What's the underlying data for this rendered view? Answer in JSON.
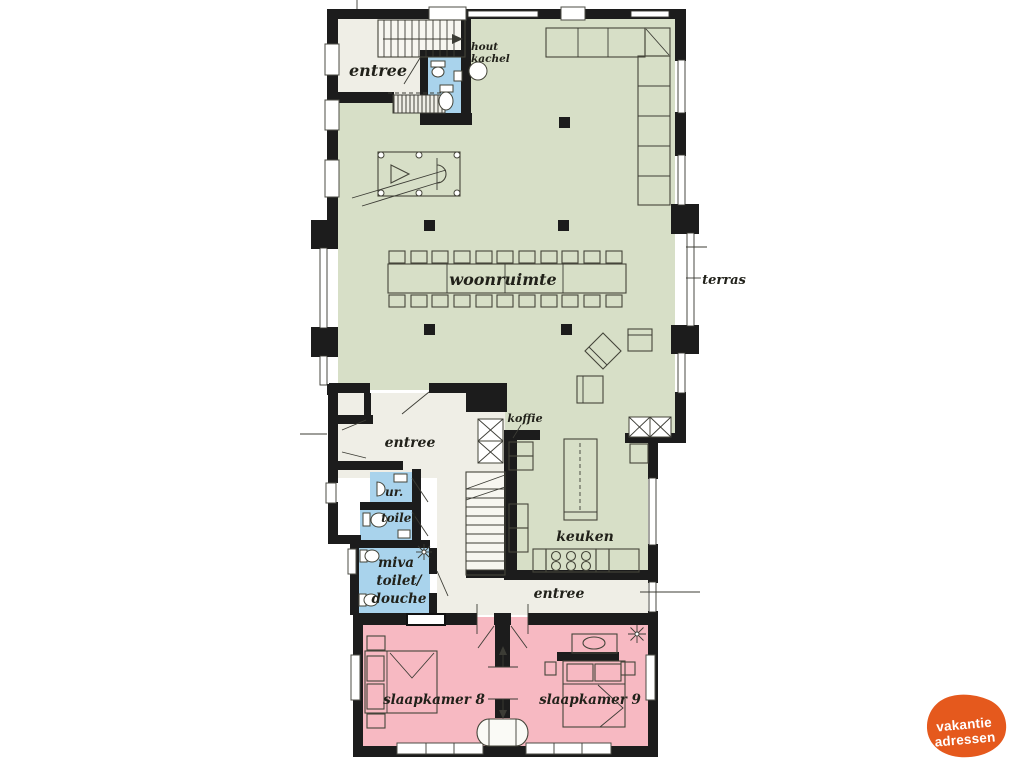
{
  "colors": {
    "bg": "#ffffff",
    "wall": "#1c1c1c",
    "green": "#d7dfc7",
    "cream": "#efeee6",
    "white_room": "#f7f6f0",
    "blue": "#a9d3ec",
    "pink": "#f7b9c2",
    "line": "#45453a",
    "label": "#21211a",
    "logo_orange": "#e5591d"
  },
  "labels": {
    "entree_top": "entree",
    "wood_stove_line1": "hout",
    "wood_stove_line2": "kachel",
    "living_room": "woonruimte",
    "terrace": "terras",
    "coffee": "koffie",
    "entree_mid": "entree",
    "urinal": "ur.",
    "toilet": "toilet",
    "miva_line1": "miva",
    "miva_line2": "toilet/",
    "miva_line3": "douche",
    "kitchen": "keuken",
    "entree_bottom": "entree",
    "bedroom8": "slaapkamer 8",
    "bedroom9": "slaapkamer 9"
  },
  "logo": {
    "line1": "vakantie",
    "line2": "adressen"
  }
}
